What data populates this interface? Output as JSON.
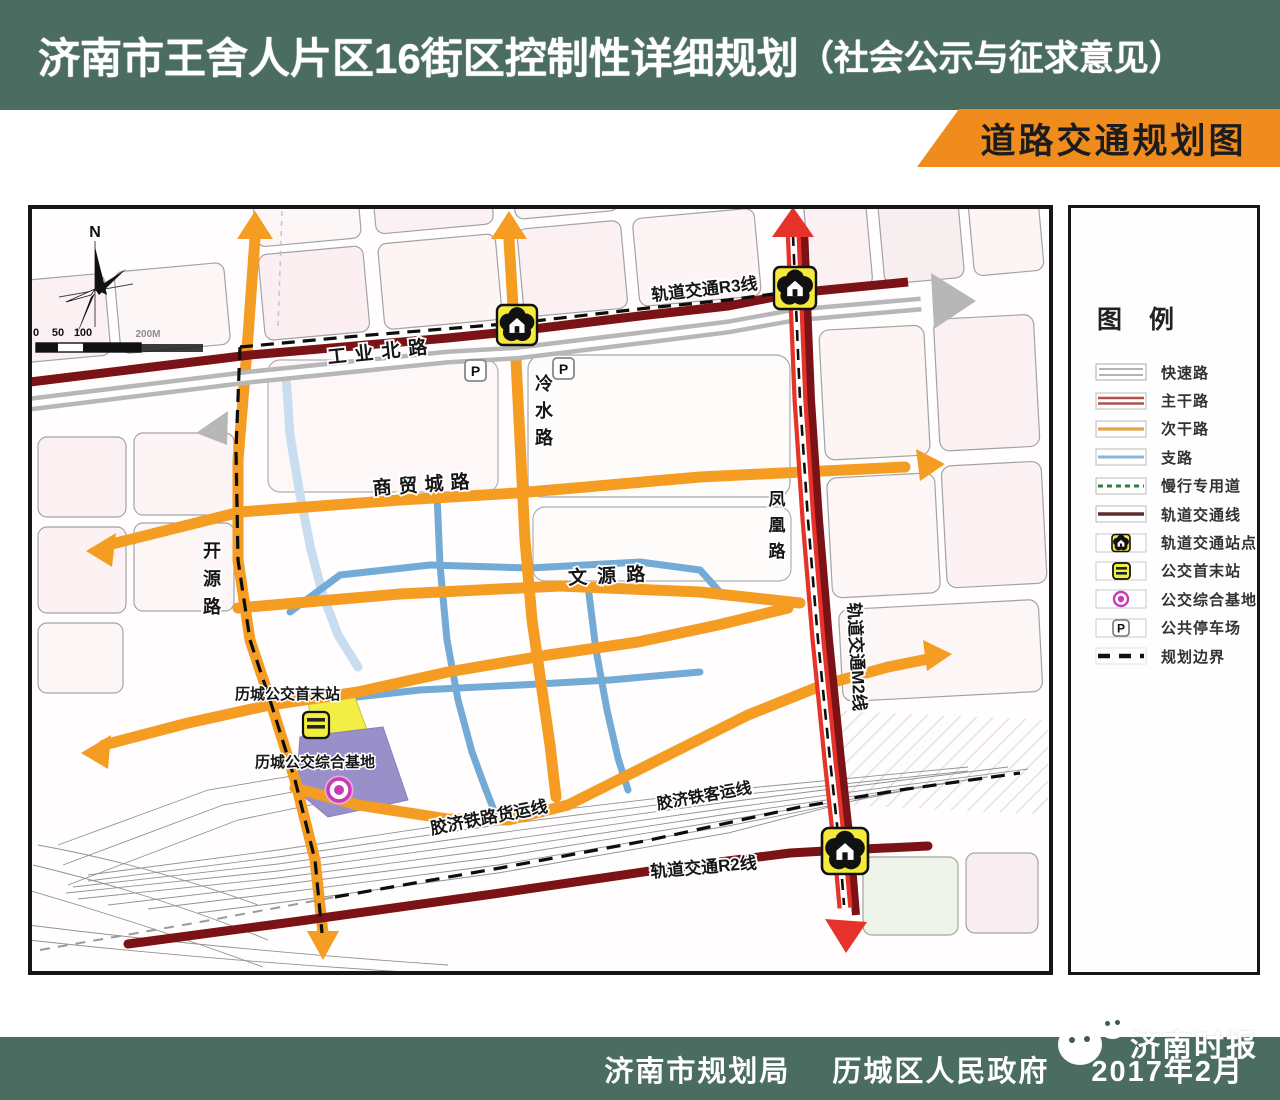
{
  "header": {
    "title_main": "济南市王舍人片区16街区控制性详细规划",
    "title_paren": "（社会公示与征求意见）"
  },
  "banner": {
    "label": "道路交通规划图"
  },
  "footer": {
    "agency1": "济南市规划局",
    "agency2": "历城区人民政府",
    "date": "2017年2月",
    "watermark": "济南时报"
  },
  "map": {
    "north_label": "N",
    "scale": {
      "ticks": [
        "0",
        "50",
        "100"
      ],
      "end": "200M"
    },
    "labels": {
      "rail_r3": "轨道交通R3线",
      "rail_m2": "轨道交通M2线",
      "rail_r2": "轨道交通R2线",
      "rail_freight": "胶济铁路货运线",
      "rail_passenger": "胶济铁客运线",
      "road_gongyebei": "工业北路",
      "road_lengshui": "冷水路",
      "road_shangmaocheng": "商贸城路",
      "road_wenyuan": "文源路",
      "road_kaiyuan": "开源路",
      "road_fenghuang": "凤凰路",
      "bus_terminal": "历城公交首末站",
      "bus_base": "历城公交综合基地",
      "parking_symbol": "P"
    }
  },
  "legend": {
    "title": "图  例",
    "items": [
      {
        "label": "快速路",
        "type": "expressway"
      },
      {
        "label": "主干路",
        "type": "arterial"
      },
      {
        "label": "次干路",
        "type": "secondary"
      },
      {
        "label": "支路",
        "type": "branch"
      },
      {
        "label": "慢行专用道",
        "type": "slow-lane"
      },
      {
        "label": "轨道交通线",
        "type": "rail-line"
      },
      {
        "label": "轨道交通站点",
        "type": "rail-station"
      },
      {
        "label": "公交首末站",
        "type": "bus-terminal"
      },
      {
        "label": "公交综合基地",
        "type": "bus-base"
      },
      {
        "label": "公共停车场",
        "type": "parking"
      },
      {
        "label": "规划边界",
        "type": "boundary"
      }
    ]
  },
  "colors": {
    "header_green": "#4a6c61",
    "banner_orange": "#f08c1e",
    "road_secondary_orange": "#f59c23",
    "road_arterial_red": "#e6332a",
    "rail_maroon": "#7a1216",
    "road_branch_blue": "#74aad6",
    "expressway_gray": "#b7b7b7",
    "station_yellow": "#f5e93c",
    "bus_base_purple": "#998fc9",
    "bus_base_magenta": "#c93bb5"
  }
}
